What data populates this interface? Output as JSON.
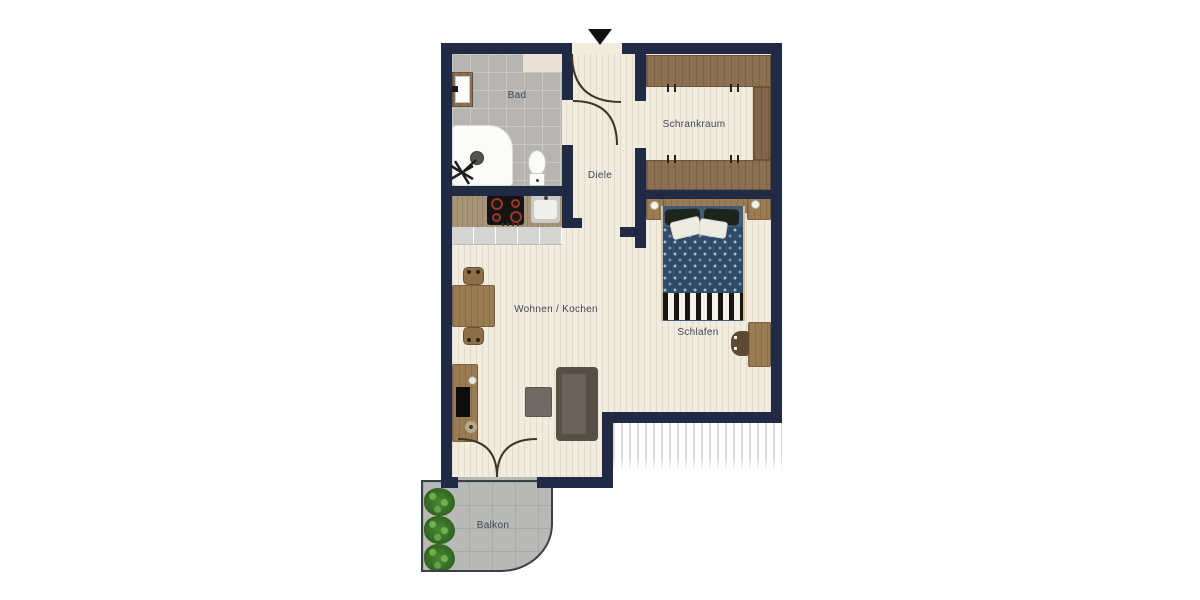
{
  "palette": {
    "wall": "#202a45",
    "floor": "#f2ecdf",
    "tile": "#b5b4b1",
    "tile_line": "#c8c7c4",
    "wood_dark": "#8d7051",
    "wood_mid": "#9b7c52",
    "counter": "#a69478",
    "cabinet_front": "#d4d4d2",
    "sofa": "#575047",
    "sofa_seat": "#6b6359",
    "bed_base": "#3f5c7a",
    "bed_duvet": "#2e4b68",
    "pillow_dark": "#1d241c",
    "label": "#3b4859",
    "balcony": "#b9b9b7",
    "balcony_line": "#a9a9a7",
    "plant": "#3e7a2e",
    "hatch": "#d9d9d6",
    "door_arc": "#3d3529",
    "accent_red": "#a23327"
  },
  "rooms": {
    "bad": {
      "label": "Bad"
    },
    "schrankraum": {
      "label": "Schrankraum"
    },
    "diele": {
      "label": "Diele"
    },
    "wohnen_kochen": {
      "label": "Wohnen / Kochen"
    },
    "schlafen": {
      "label": "Schlafen"
    },
    "balkon": {
      "label": "Balkon"
    }
  }
}
